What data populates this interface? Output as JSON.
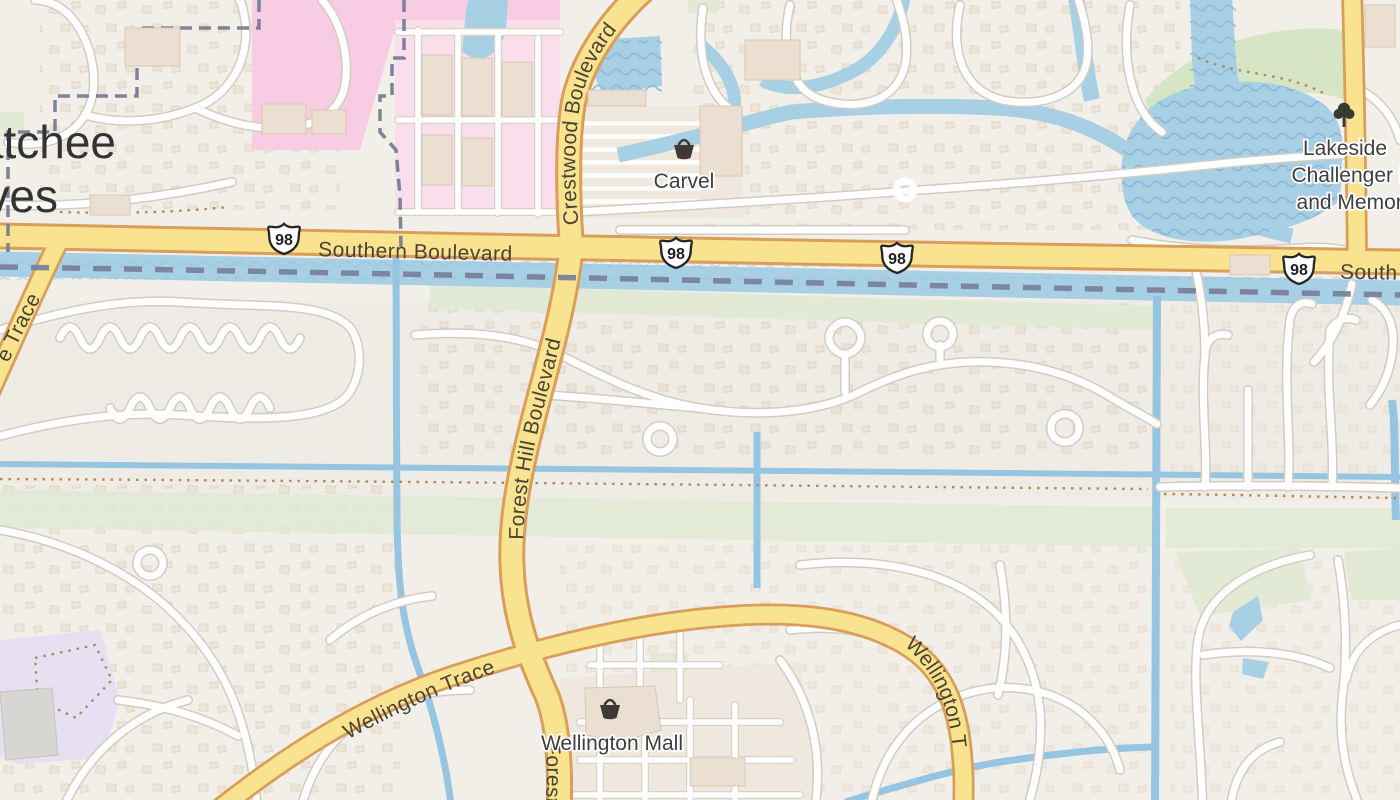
{
  "place": {
    "line1": "atchee",
    "line2": "ves"
  },
  "roads": {
    "southern": "Southern Boulevard",
    "southern_fragment": "South",
    "crestwood": "Crestwood Boulevard",
    "forest_hill": "Forest Hill Boulevard",
    "wellington_trace": "Wellington Trace",
    "wellington_trace_fragment": "Wellington T",
    "trace_fragment": "e Trace"
  },
  "shields": [
    "98",
    "98",
    "98",
    "98"
  ],
  "pois": {
    "carvel": {
      "name": "Carvel",
      "icon": "shop-basket-icon"
    },
    "wellington_mall": {
      "name": "Wellington Mall",
      "icon": "shop-basket-icon"
    },
    "lakeside_park": {
      "lines": [
        "Lakeside",
        "Challenger Pa",
        "and Memori"
      ],
      "icon": "tree-icon"
    }
  },
  "colors": {
    "land": "#f2efe9",
    "water": "#a8d0e5",
    "road_major_fill": "#f9e38e",
    "road_major_casing": "#d99e5b",
    "road_minor_fill": "#ffffff",
    "green_area": "#e2e9d5",
    "park_green": "#d6e5c3",
    "school_pink": "#f8cce2",
    "lavender_area": "#e7e0f2",
    "boundary": "#6f7890",
    "label_text": "#3e3e3e"
  }
}
